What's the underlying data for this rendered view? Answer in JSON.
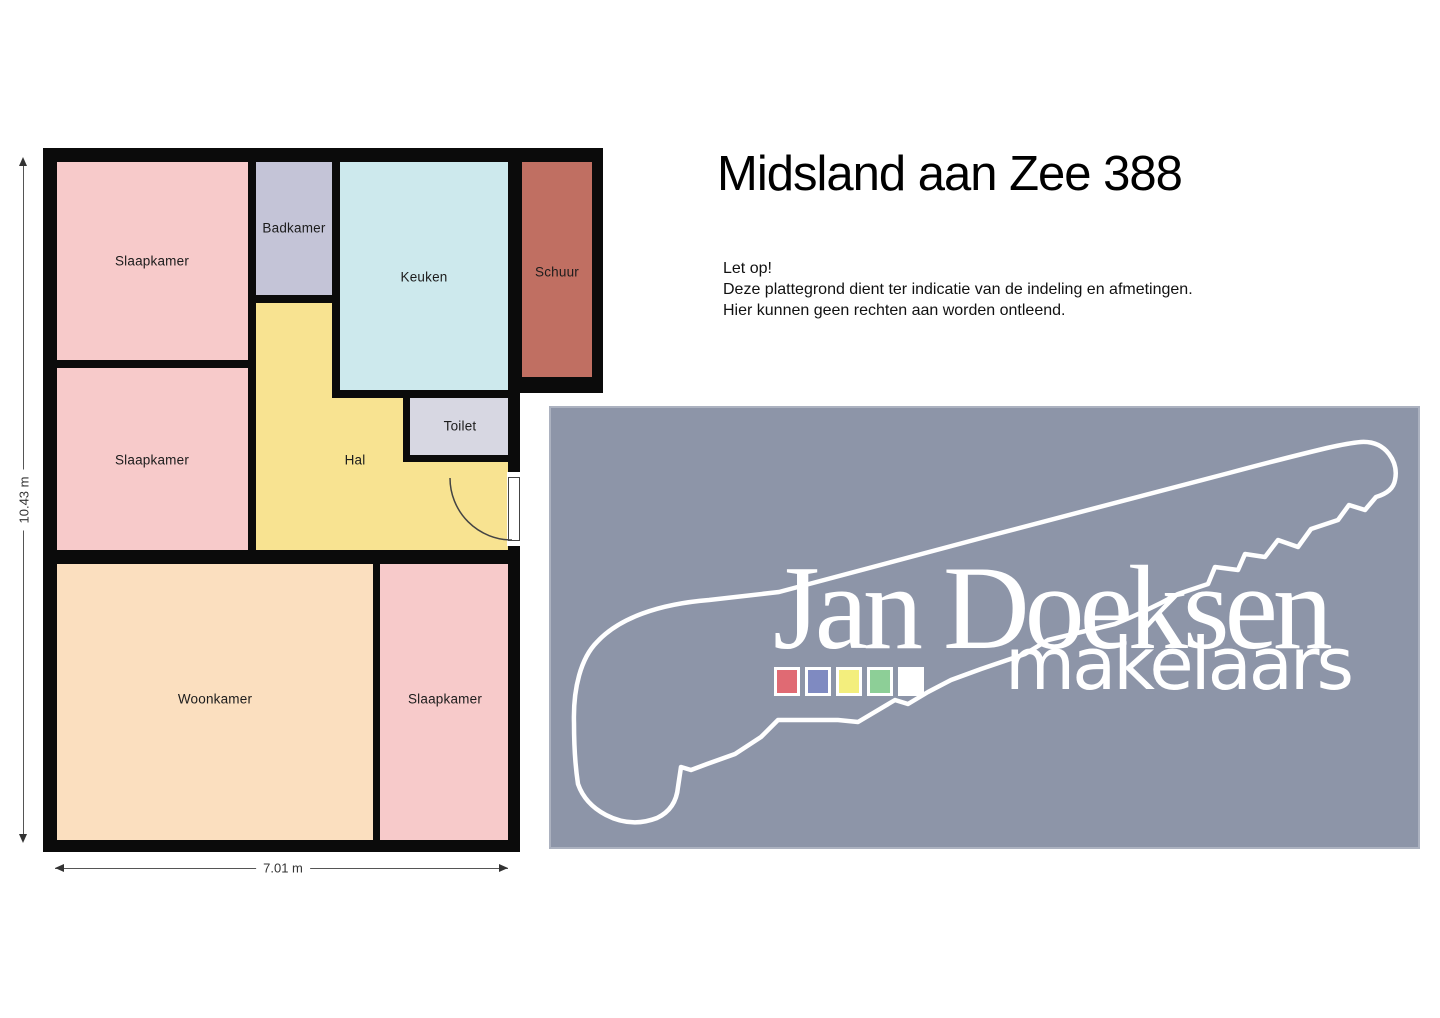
{
  "title": "Midsland aan Zee 388",
  "notice": {
    "heading": "Let op!",
    "line1": "Deze plattegrond dient ter indicatie van de indeling en afmetingen.",
    "line2": "Hier kunnen geen rechten aan worden ontleend."
  },
  "floorplan": {
    "wall_color": "#0b0b0b",
    "dim_width": "7.01 m",
    "dim_height": "10.43 m",
    "blocks": [
      {
        "name": "main-building-walls",
        "x": 0,
        "y": 0,
        "w": 477,
        "h": 704
      },
      {
        "name": "schuur-walls",
        "x": 464,
        "y": 0,
        "w": 96,
        "h": 245
      }
    ],
    "rooms": [
      {
        "name": "room-slaapkamer-1",
        "label": "Slaapkamer",
        "x": 14,
        "y": 14,
        "w": 191,
        "h": 198,
        "color": "#f7caca"
      },
      {
        "name": "room-badkamer",
        "label": "Badkamer",
        "x": 213,
        "y": 14,
        "w": 76,
        "h": 133,
        "color": "#c4c4d7"
      },
      {
        "name": "room-keuken",
        "label": "Keuken",
        "x": 297,
        "y": 14,
        "w": 168,
        "h": 228,
        "color": "#cde9ed"
      },
      {
        "name": "room-schuur",
        "label": "Schuur",
        "x": 479,
        "y": 14,
        "w": 70,
        "h": 215,
        "color": "#c06f62"
      },
      {
        "name": "room-slaapkamer-2",
        "label": "Slaapkamer",
        "x": 14,
        "y": 220,
        "w": 191,
        "h": 182,
        "color": "#f7caca"
      },
      {
        "name": "room-hal-upper",
        "label": "",
        "x": 213,
        "y": 155,
        "w": 76,
        "h": 247,
        "color": "#f8e391"
      },
      {
        "name": "room-hal-middle",
        "label": "",
        "x": 289,
        "y": 250,
        "w": 71,
        "h": 152,
        "color": "#f8e391"
      },
      {
        "name": "room-hal-lower",
        "label": "",
        "x": 360,
        "y": 314,
        "w": 105,
        "h": 88,
        "color": "#f8e391"
      },
      {
        "name": "room-toilet",
        "label": "Toilet",
        "x": 367,
        "y": 250,
        "w": 98,
        "h": 57,
        "color": "#d7d7e2"
      },
      {
        "name": "room-woonkamer",
        "label": "Woonkamer",
        "x": 14,
        "y": 416,
        "w": 316,
        "h": 276,
        "color": "#fbdfbf"
      },
      {
        "name": "room-slaapkamer-3",
        "label": "Slaapkamer",
        "x": 337,
        "y": 416,
        "w": 128,
        "h": 276,
        "color": "#f7caca"
      }
    ],
    "labels": [
      {
        "name": "label-slaapkamer-1",
        "text": "Slaapkamer",
        "x": 109,
        "y": 113
      },
      {
        "name": "label-badkamer",
        "text": "Badkamer",
        "x": 251,
        "y": 80
      },
      {
        "name": "label-keuken",
        "text": "Keuken",
        "x": 381,
        "y": 129
      },
      {
        "name": "label-schuur",
        "text": "Schuur",
        "x": 514,
        "y": 124
      },
      {
        "name": "label-slaapkamer-2",
        "text": "Slaapkamer",
        "x": 109,
        "y": 312
      },
      {
        "name": "label-hal",
        "text": "Hal",
        "x": 312,
        "y": 312
      },
      {
        "name": "label-toilet",
        "text": "Toilet",
        "x": 417,
        "y": 278
      },
      {
        "name": "label-woonkamer",
        "text": "Woonkamer",
        "x": 172,
        "y": 551
      },
      {
        "name": "label-slaapkamer-3",
        "text": "Slaapkamer",
        "x": 402,
        "y": 551
      }
    ]
  },
  "logo": {
    "bg": "#8d95a8",
    "brand": "Jan Doeksen",
    "brand_sub": "makelaars",
    "squares": [
      {
        "name": "legend-square-red",
        "color": "#e06a73"
      },
      {
        "name": "legend-square-blue",
        "color": "#7f8ac1"
      },
      {
        "name": "legend-square-yellow",
        "color": "#f3ee7d"
      },
      {
        "name": "legend-square-green",
        "color": "#8dcf97"
      },
      {
        "name": "legend-square-white",
        "color": "#ffffff"
      }
    ]
  }
}
